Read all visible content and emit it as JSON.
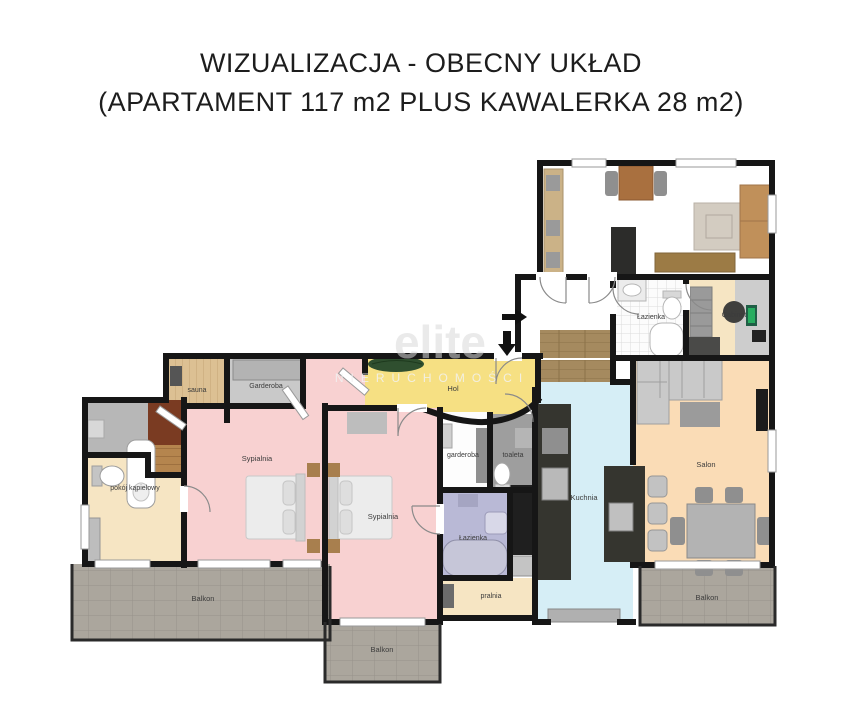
{
  "title": {
    "line1": "WIZUALIZACJA - OBECNY UKŁAD",
    "line2": "(APARTAMENT 117 m2 PLUS KAWALERKA 28 m2)"
  },
  "watermark": {
    "brand": "elite",
    "subtitle": "NIERUCHOMOŚCI"
  },
  "rooms": {
    "sauna": "sauna",
    "garderoba": "Garderoba",
    "hol": "Hol",
    "sypialnia1": "Sypialnia",
    "sypialnia2": "Sypialnia",
    "pokoj_kapielowy": "pokój kąpielowy",
    "garderoba_small": "garderoba",
    "toaleta": "toaleta",
    "lazienka": "Łazienka",
    "pralnia": "pralnia",
    "kuchnia": "Kuchnia",
    "salon": "Salon",
    "balkon_left": "Balkon",
    "balkon_middle": "Balkon",
    "balkon_right": "Balkon",
    "lazienka_kawalerka": "Łazienka",
    "gabinet": "Gabinet"
  },
  "icons": {
    "entry_arrow_right": "→",
    "entry_arrow_down": "↓"
  },
  "colors": {
    "wall": "#161616",
    "bedroom_pink": "#f8d1d1",
    "hall_yellow": "#f6e083",
    "kitchen_blue": "#d6eef6",
    "salon_peach": "#fadcb6",
    "cream": "#f6e5c3",
    "bath_lavender": "#b9b9d6",
    "gray_floor": "#c9c9c9",
    "toilet_gray": "#9e9e9e",
    "balcony_gray": "#aba69d",
    "wood": "#a58a5f",
    "sauna_wood": "#dcc093",
    "cabinet_charcoal": "#35352f"
  }
}
